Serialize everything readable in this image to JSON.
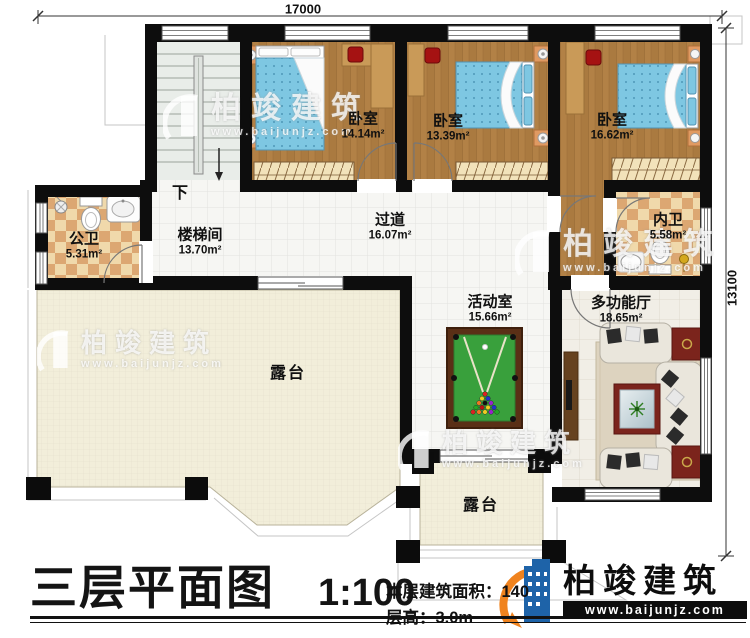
{
  "dimensions": {
    "top": "17000",
    "right": "13100"
  },
  "rooms": [
    {
      "name": "卧室",
      "area": "14.14m²"
    },
    {
      "name": "卧室",
      "area": "13.39m²"
    },
    {
      "name": "卧室",
      "area": "16.62m²"
    },
    {
      "name": "公卫",
      "area": "5.31m²"
    },
    {
      "name": "楼梯间",
      "area": "13.70m²"
    },
    {
      "name": "过道",
      "area": "16.07m²"
    },
    {
      "name": "内卫",
      "area": "5.58m²"
    },
    {
      "name": "活动室",
      "area": "15.66m²"
    },
    {
      "name": "多功能厅",
      "area": "18.65m²"
    },
    {
      "name": "露台",
      "area": ""
    },
    {
      "name": "露台",
      "area": ""
    }
  ],
  "stair": {
    "direction_label": "下"
  },
  "titleblock": {
    "title": "三层平面图",
    "scale": "1:100",
    "area_text": "本层建筑面积：140",
    "floor_height_text": "层高：3.0m"
  },
  "brand": {
    "name": "柏竣建筑",
    "website": "www.baijunjz.com"
  },
  "watermark": {
    "name": "柏竣建筑",
    "website": "www.baijunjz.com"
  },
  "colors": {
    "wall": "#0d0d0d",
    "wood_floor": "#aa7a40",
    "tile_light": "#f6f6f3",
    "checker_tan": "#dca772",
    "terrace": "#f2eeda",
    "billiard_felt": "#39a03c",
    "bed_blue": "#7ec7e2",
    "brand_blue": "#1e63a8",
    "brand_orange": "#f0831e"
  }
}
